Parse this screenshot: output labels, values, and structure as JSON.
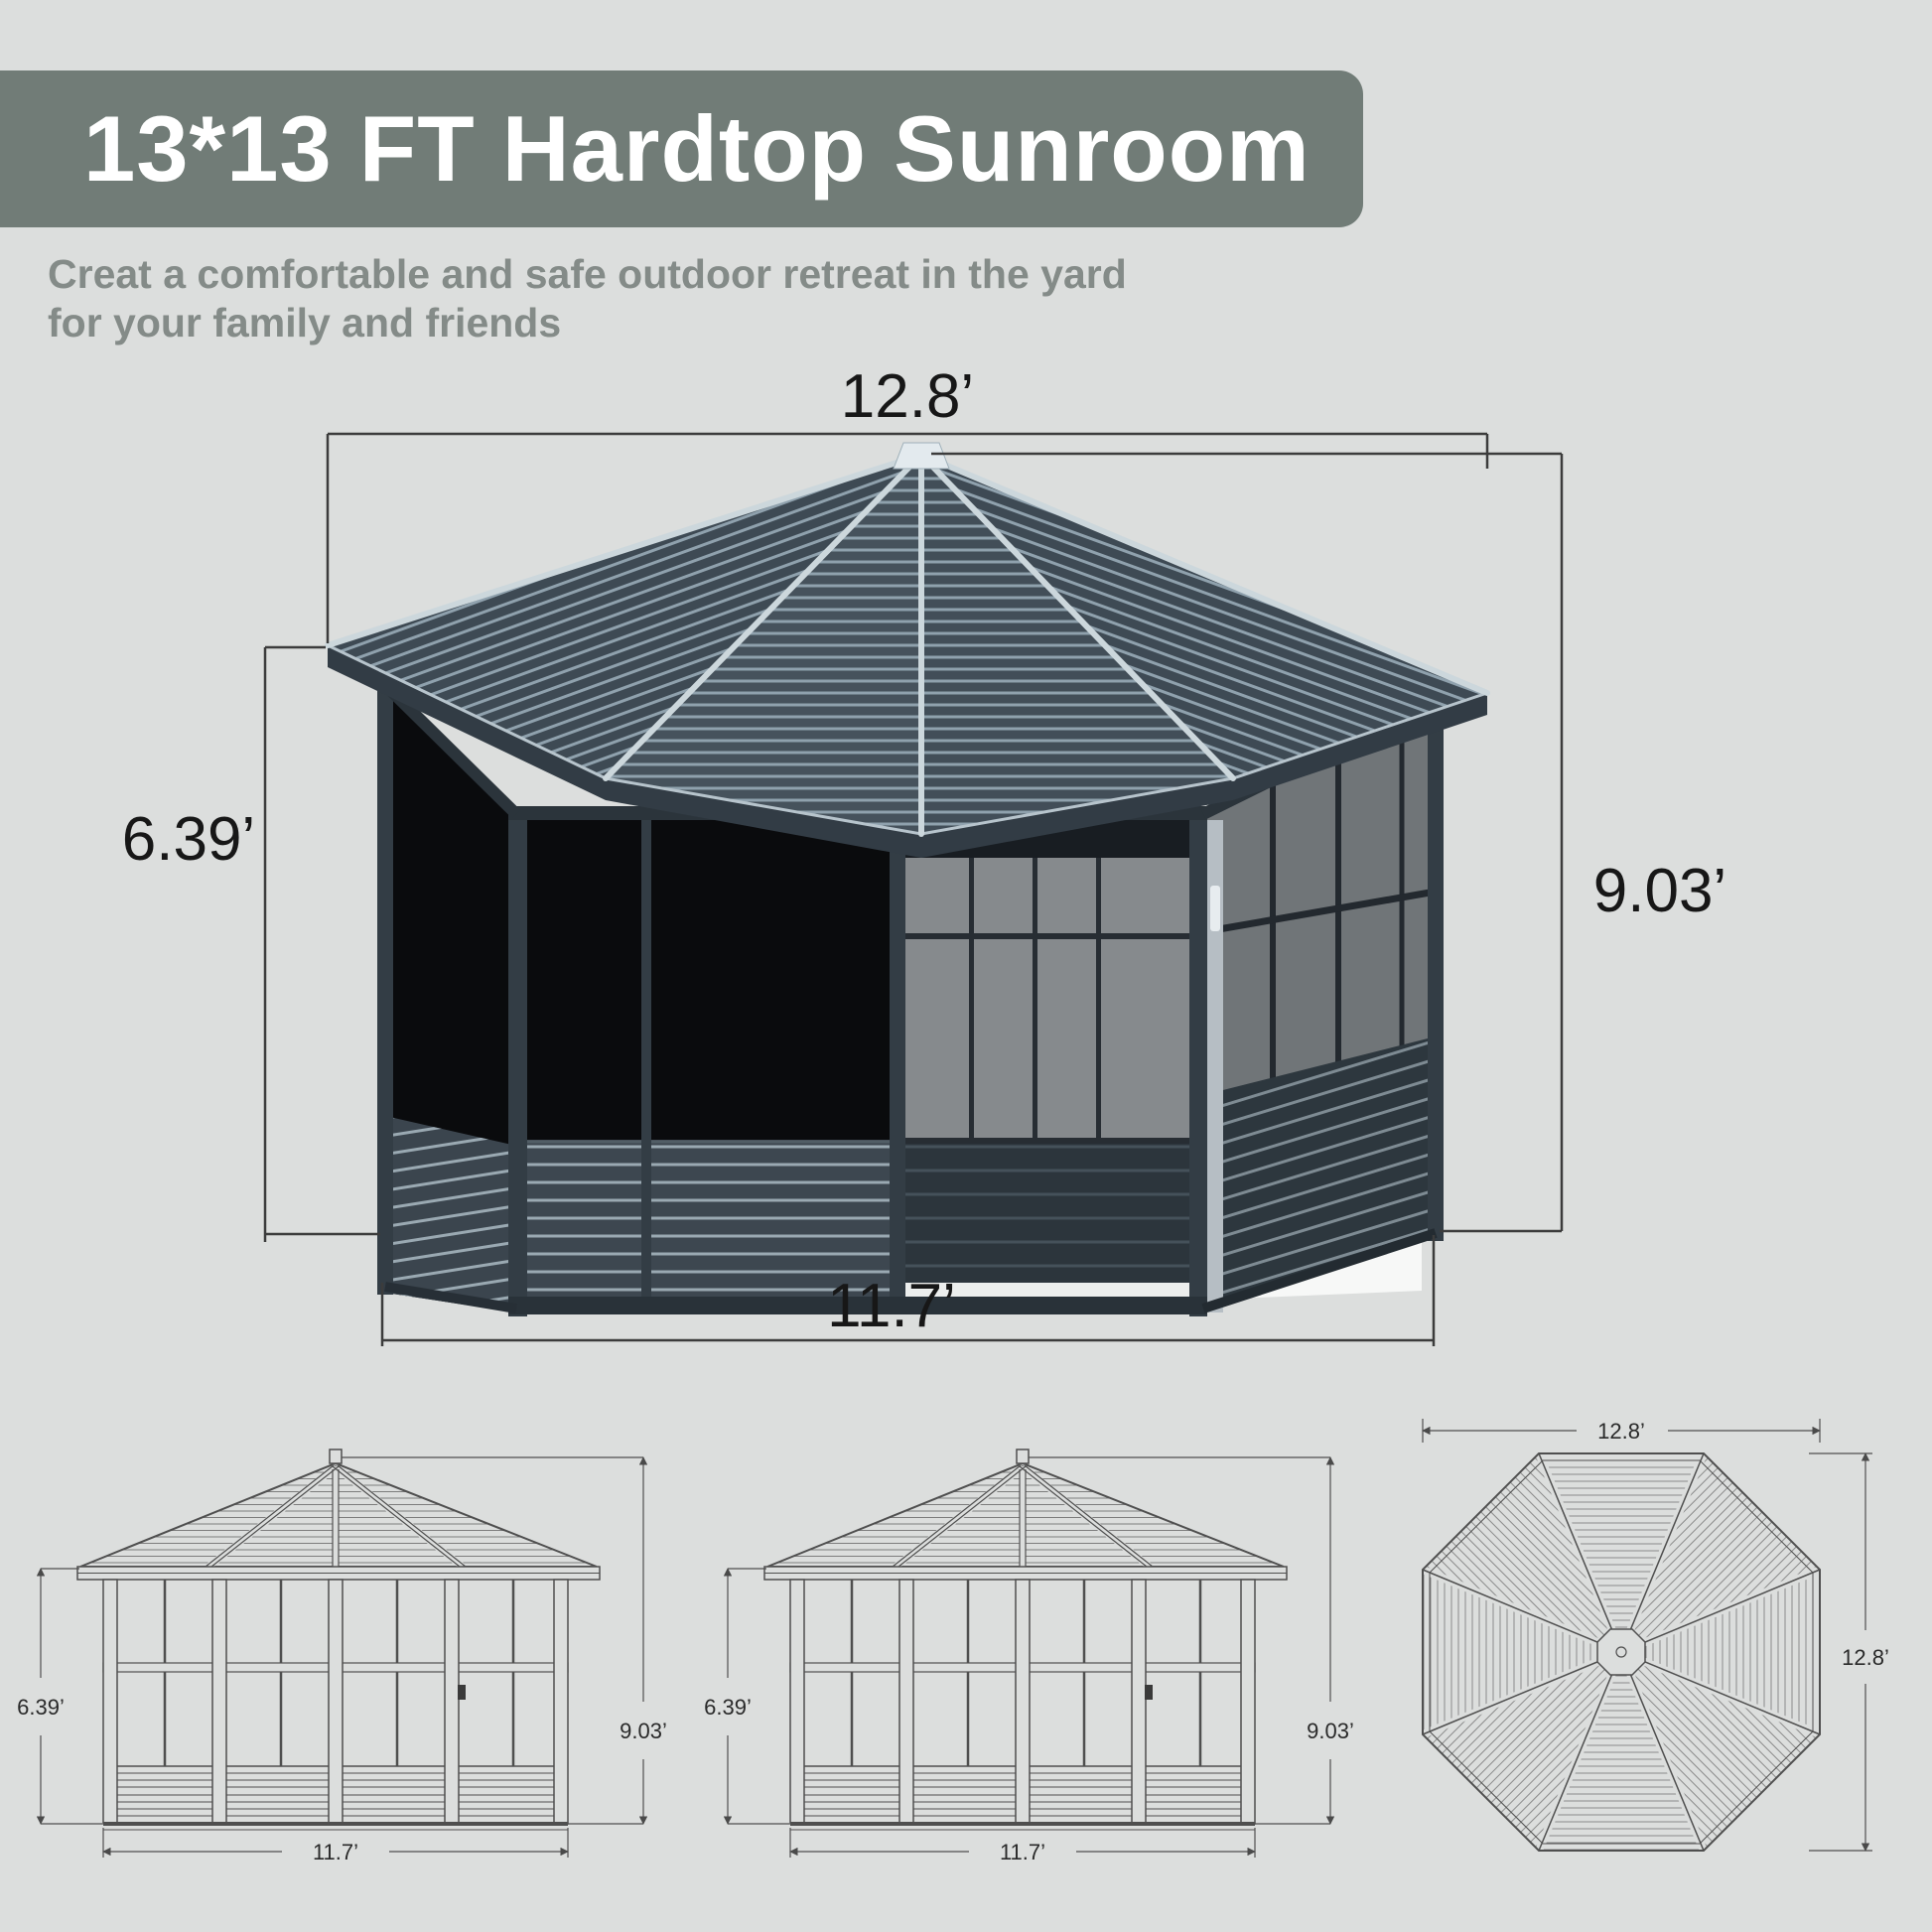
{
  "page": {
    "background": "#dcdedd"
  },
  "banner": {
    "title": "13*13 FT Hardtop Sunroom",
    "bg_color": "#717c77",
    "text_color": "#ffffff"
  },
  "subtitle": {
    "line1": "Creat a comfortable and safe outdoor retreat in the yard",
    "line2": "for your family and friends",
    "color": "#848b88"
  },
  "main_diagram": {
    "description": "photo of octagonal hardtop sunroom gazebo with dimension lines",
    "dimensions": {
      "roof_width": "12.8’",
      "wall_height": "6.39’",
      "total_height": "9.03’",
      "base_width": "11.7’"
    }
  },
  "drawings": {
    "front_elevation": {
      "wall_height": "6.39’",
      "total_height": "9.03’",
      "base_width": "11.7’"
    },
    "rear_elevation": {
      "wall_height": "6.39’",
      "total_height": "9.03’",
      "base_width": "11.7’"
    },
    "top_view": {
      "width": "12.8’",
      "depth": "12.8’"
    }
  },
  "colors": {
    "roof_dark": "#3e4a54",
    "roof_ridge_light": "#ccd7dc",
    "wall_screen_black": "#0a0b0d",
    "frame_dark": "#333d45",
    "wainscot": "#3d4750",
    "interior_gray": "#868a8d",
    "dimension_line": "#3c3c3c",
    "drawing_line": "#4f4f4f"
  }
}
